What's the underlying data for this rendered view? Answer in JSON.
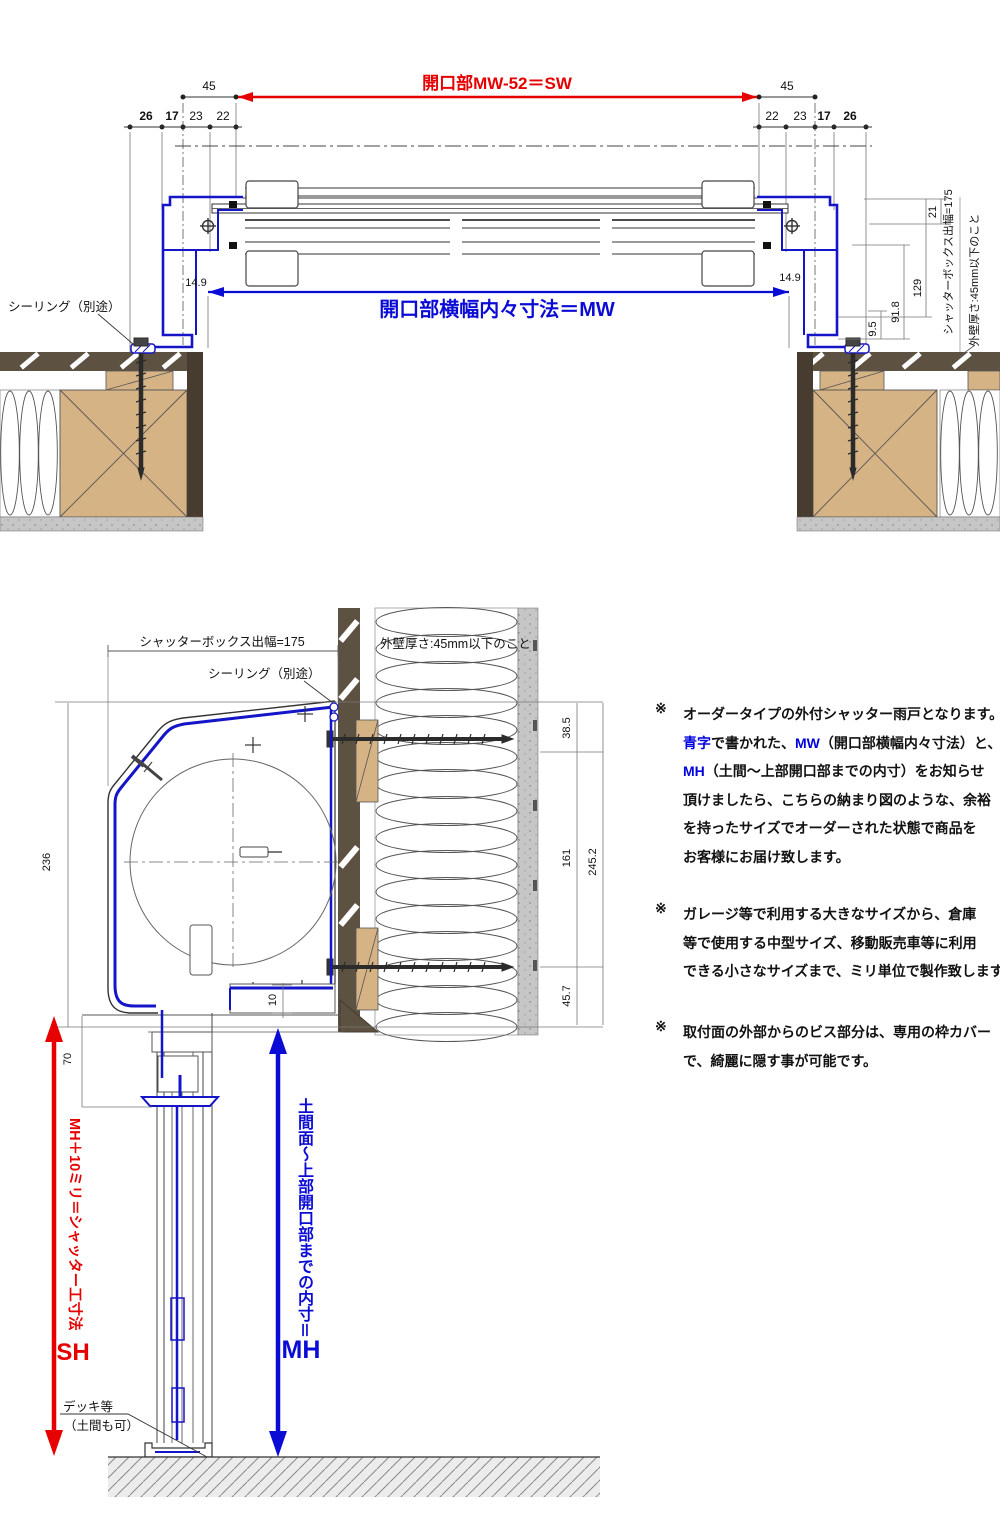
{
  "colors": {
    "red": "#e60000",
    "blue": "#0b0bd6",
    "frame_blue": "#1414c8",
    "wood": "#d6b384",
    "siding": "#5d5142",
    "siding_dark": "#483c30",
    "gray_band": "#c6c6c6",
    "ground": "#ececec"
  },
  "top": {
    "red_dim": "開口部MW-52＝SW",
    "blue_dim": "開口部横幅内々寸法＝MW",
    "sealing": "シーリング（別途）",
    "d45_l": "45",
    "d45_r": "45",
    "chain_l": {
      "d26": "26",
      "d17": "17",
      "d23": "23",
      "d22": "22"
    },
    "chain_r": {
      "d22": "22",
      "d23": "23",
      "d17": "17",
      "d26": "26"
    },
    "inner_l": "14.9",
    "inner_r": "14.9",
    "d21": "21",
    "d129": "129",
    "d91_8": "91.8",
    "d9_5": "9.5",
    "box_width": "シャッターボックス出幅=175",
    "wall_note": "外壁厚さ:45mm以下のこと"
  },
  "bottom": {
    "box_width": "シャッターボックス出幅=175",
    "sealing": "シーリング（別途）",
    "wall_note": "外壁厚さ:45mm以下のこと",
    "d236": "236",
    "d70": "70",
    "d10": "10",
    "d38_5": "38.5",
    "d161": "161",
    "d45_7": "45.7",
    "d245_2": "245.2",
    "red_v": "MH＋10ミリ＝シャッター工寸法",
    "red_h": "SH",
    "blue_v": "土間面～上部開口部までの内寸＝",
    "blue_h": "MH",
    "deck1": "デッキ等",
    "deck2": "（土間も可）"
  },
  "notes": [
    {
      "marker": "※",
      "lines": [
        {
          "segs": [
            {
              "t": "オーダータイプの外付シャッター雨戸となります。",
              "c": "k"
            }
          ]
        },
        {
          "segs": [
            {
              "t": "青字",
              "c": "b"
            },
            {
              "t": "で書かれた、",
              "c": "k"
            },
            {
              "t": "MW",
              "c": "b"
            },
            {
              "t": "（開口部横幅内々寸法）と、",
              "c": "k"
            }
          ]
        },
        {
          "segs": [
            {
              "t": "MH",
              "c": "b"
            },
            {
              "t": "（土間～上部開口部までの内寸）をお知らせ",
              "c": "k"
            }
          ]
        },
        {
          "segs": [
            {
              "t": "頂けましたら、こちらの納まり図のような、余裕",
              "c": "k"
            }
          ]
        },
        {
          "segs": [
            {
              "t": "を持ったサイズでオーダーされた状態で商品を",
              "c": "k"
            }
          ]
        },
        {
          "segs": [
            {
              "t": "お客様にお届け致します。",
              "c": "k"
            }
          ]
        }
      ]
    },
    {
      "marker": "※",
      "lines": [
        {
          "segs": [
            {
              "t": "ガレージ等で利用する大きなサイズから、倉庫",
              "c": "k"
            }
          ]
        },
        {
          "segs": [
            {
              "t": "等で使用する中型サイズ、移動販売車等に利用",
              "c": "k"
            }
          ]
        },
        {
          "segs": [
            {
              "t": "できる小さなサイズまで、ミリ単位で製作致します。",
              "c": "k"
            }
          ]
        }
      ]
    },
    {
      "marker": "※",
      "lines": [
        {
          "segs": [
            {
              "t": "取付面の外部からのビス部分は、専用の枠カバー",
              "c": "k"
            }
          ]
        },
        {
          "segs": [
            {
              "t": "で、綺麗に隠す事が可能です。",
              "c": "k"
            }
          ]
        }
      ]
    }
  ]
}
